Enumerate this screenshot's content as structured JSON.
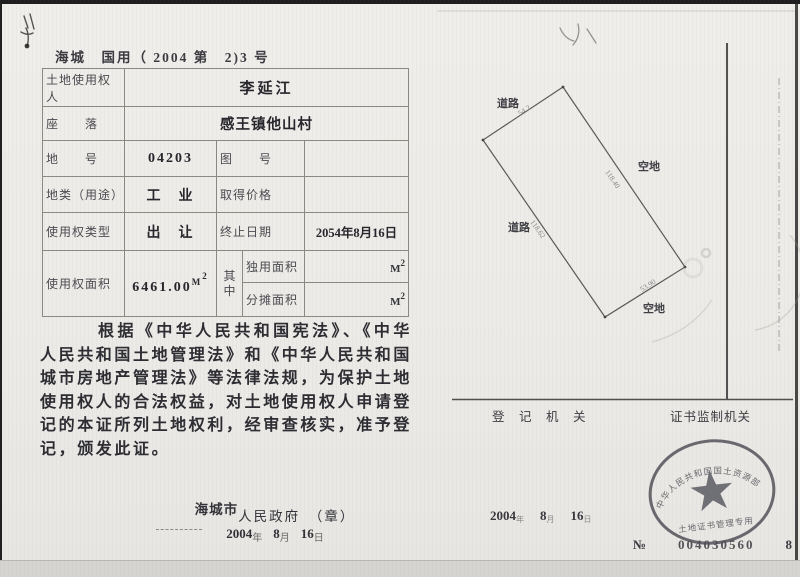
{
  "doc": {
    "header_no": "海城　国用（ 2004 第　2)3 号"
  },
  "table": {
    "holder_label": "土地使用权人",
    "holder_value": "李延江",
    "location_label": "座　　落",
    "location_value": "感王镇他山村",
    "parcel_no_label": "地　　号",
    "parcel_no_value": "04203",
    "map_no_label": "图　　号",
    "map_no_value": "",
    "land_use_label": "地类（用途）",
    "land_use_value": "工　业",
    "price_label": "取得价格",
    "price_value": "",
    "right_type_label": "使用权类型",
    "right_type_value": "出　让",
    "end_date_label": "终止日期",
    "end_date_value": "2054年8月16日",
    "area_label": "使用权面积",
    "area_value": "6461.00",
    "area_unit_base": "M",
    "area_unit_sup": "2",
    "among_label": "其中",
    "exclusive_label": "独用面积",
    "exclusive_unit_base": "M",
    "exclusive_unit_sup": "2",
    "apportioned_label": "分摊面积",
    "apportioned_unit_base": "M",
    "apportioned_unit_sup": "2"
  },
  "body_paragraph": "根据《中华人民共和国宪法》、《中华人民共和国土地管理法》和《中华人民共和国城市房地产管理法》等法律法规，为保护土地使用权人的合法权益，对土地使用权人申请登记的本证所列土地权利，经审查核实，准予登记，颁发此证。",
  "issuing": {
    "city_handwritten": "海城市",
    "gov_label": "人民政府　（章）",
    "year": "2004",
    "year_unit": "年",
    "month": "8",
    "month_unit": "月",
    "day": "16",
    "day_unit": "日"
  },
  "diagram": {
    "road_top": "道路",
    "road_left": "道路",
    "vacant_right": "空地",
    "vacant_bottom": "空地",
    "dim_top": "54.2",
    "dim_right": "118.40",
    "dim_left": "118.62",
    "dim_bottom": "53.90"
  },
  "registry": {
    "org_label": "登　记　机　关",
    "supervisor_label": "证书监制机关",
    "date_year": "2004",
    "date_year_unit": "年",
    "date_month": "8",
    "date_month_unit": "月",
    "date_day": "16",
    "date_day_unit": "日",
    "seal_arc_text": "中华人民共和国国土资源部",
    "seal_bottom_text": "土地证书管理专用",
    "serial_prefix": "№",
    "serial_number": "004030560",
    "serial_tail": "8"
  }
}
